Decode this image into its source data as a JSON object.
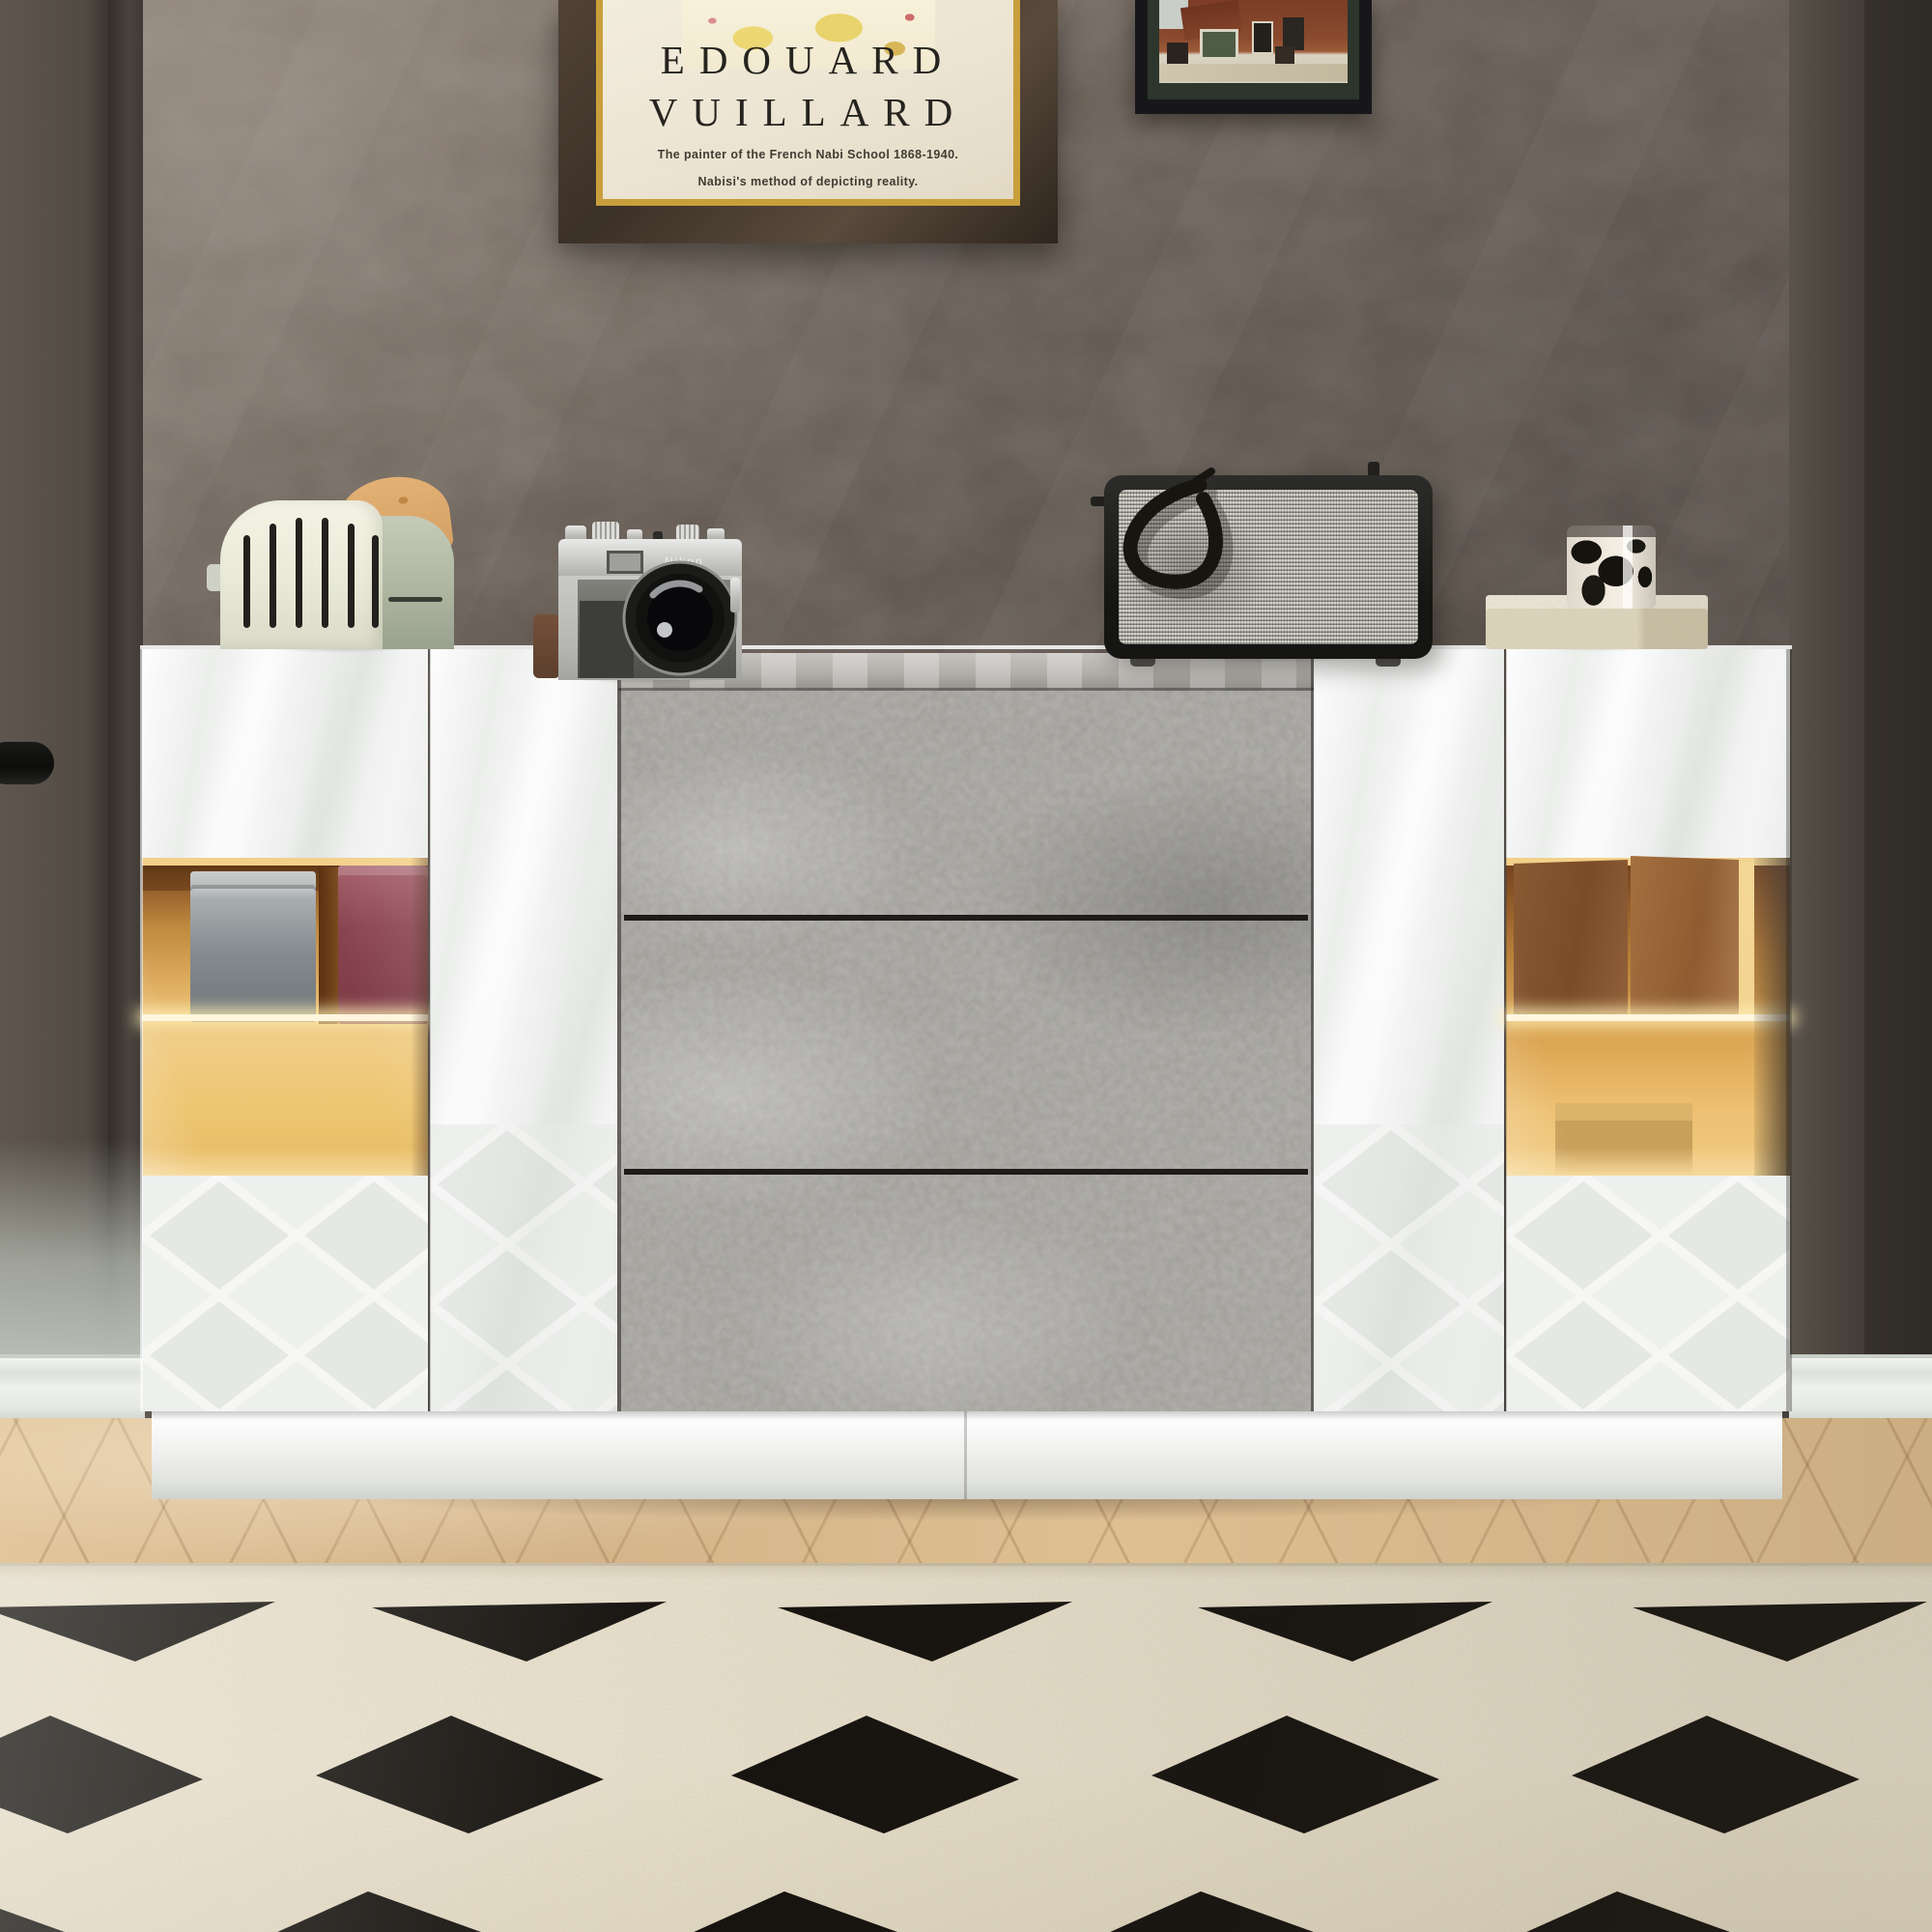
{
  "meta": {
    "description": "Product lifestyle photo: modern high-gloss white LED sideboard with concrete-gray center drawers in a living room with dark concrete wall, framed art, herringbone wood floor and cream rug with black diamonds."
  },
  "poster_vuillard": {
    "title_line1": "EDOUARD",
    "title_line2": "VUILLARD",
    "subtitle_line1": "The painter of the French Nabi School 1868-1940.",
    "subtitle_line2": "Nabisi's method of depicting reality.",
    "paper_color": "#efe8d8",
    "frame_color": "#46382b",
    "trim_color": "#c99f3c"
  },
  "poster_street": {
    "label": "framed photo of old brick house",
    "frame_color": "#17171a",
    "matte_color": "#2c362c"
  },
  "cabinet": {
    "style": "high-gloss white sideboard, LED glass displays, 3D diamond lower doors",
    "left_block": {
      "top_door": "glossy white",
      "display": "LED-lit amber glass with silver tin and maroon box",
      "bottom_door": "3D diamond white"
    },
    "center_block": {
      "drawers": 3,
      "finish": "concrete gray"
    },
    "right_block": {
      "top_door": "glossy white",
      "display": "LED-lit amber glass with kraft bags and tan box",
      "bottom_door": "3D diamond white"
    },
    "plinth_color": "#eef0ee",
    "led_glow_color": "#f3cf82",
    "concrete_color": "#9d9b96"
  },
  "objects": {
    "toaster": {
      "label": "retro cream toaster with toast slice",
      "body_color": "#eceddc",
      "side_color": "#b2bba7"
    },
    "camera": {
      "label": "vintage rangefinder camera",
      "brand_label": "Nikon"
    },
    "speaker": {
      "label": "retro fabric-grille speaker with coiled cord",
      "grille_color": "#d4d2ca"
    },
    "cup": {
      "label": "black and white patterned tumbler on stone tray"
    }
  },
  "wall": {
    "base_color": "#5e554d",
    "left_column_color": "#514a43",
    "right_column_color": "#36312c"
  },
  "floor": {
    "wood_color": "#d9bb90",
    "rug_color": "#e8e0cc",
    "rug_diamond_color": "#16130f"
  },
  "rug_shapes": {
    "row1": [
      "-20,1664 285,1658 140,1720",
      "385,1664 690,1658 545,1720",
      "805,1664 1110,1658 965,1720",
      "1240,1664 1545,1658 1400,1720",
      "1690,1664 1995,1658 1850,1720"
    ],
    "row2": [
      "-88,1838 52,1776 210,1842 70,1898",
      "327,1838 467,1776 625,1842 485,1898",
      "757,1838 897,1776 1055,1842 915,1898",
      "1192,1838 1332,1776 1490,1842 1350,1898",
      "1627,1838 1767,1776 1925,1842 1785,1898"
    ],
    "row3": [
      "-193,2022 -50,1958 145,2028 0,2094",
      "238,2022 381,1958 576,2028 431,2094",
      "669,2022 812,1958 1007,2028 862,2094",
      "1100,2022 1243,1958 1438,2028 1293,2094",
      "1531,2022 1674,1958 1869,2028 1724,2094"
    ]
  }
}
